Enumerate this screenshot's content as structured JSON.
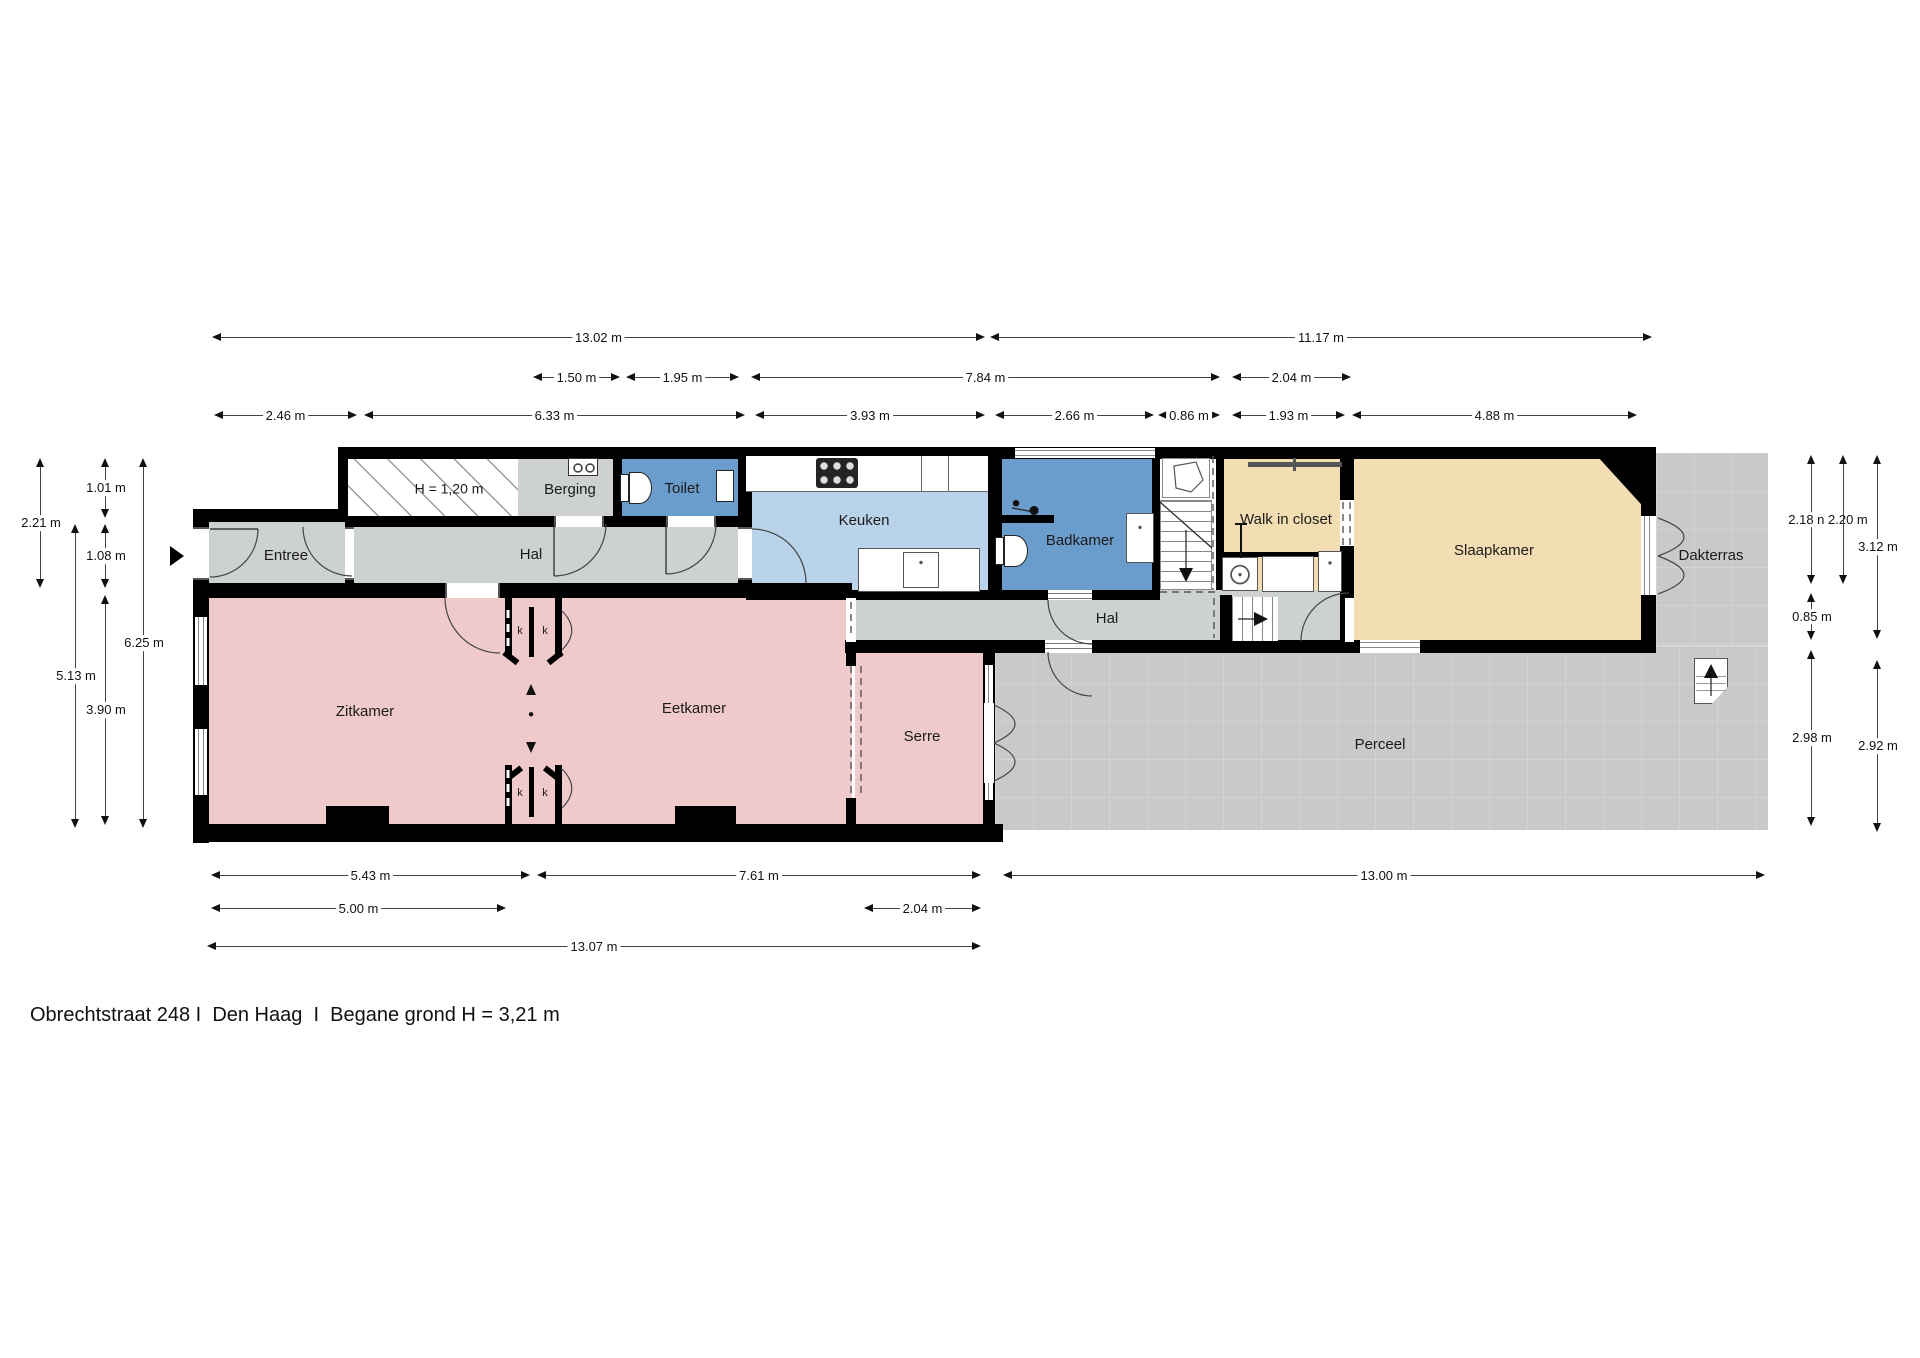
{
  "title": "Obrechtstraat 248 I  Den Haag  I  Begane grond H = 3,21 m",
  "rooms": {
    "entree": "Entree",
    "hal_front": "Hal",
    "berging": "Berging",
    "toilet": "Toilet",
    "low_height": "H = 1,20 m",
    "keuken": "Keuken",
    "badkamer": "Badkamer",
    "hal_back": "Hal",
    "walk_in_closet": "Walk in closet",
    "slaapkamer": "Slaapkamer",
    "dakterras": "Dakterras",
    "zitkamer": "Zitkamer",
    "eetkamer": "Eetkamer",
    "serre": "Serre",
    "perceel": "Perceel",
    "closet_marker": "k"
  },
  "dimensions": {
    "t1": "13.02 m",
    "t2": "11.17 m",
    "t3": "1.50 m",
    "t4": "1.95 m",
    "t5": "7.84 m",
    "t6": "2.04 m",
    "t7": "2.46 m",
    "t8": "6.33 m",
    "t9": "3.93 m",
    "t10": "2.66 m",
    "t11": "0.86 m",
    "t12": "1.93 m",
    "t13": "4.88 m",
    "b1": "5.43 m",
    "b2": "7.61 m",
    "b3": "13.00 m",
    "b4": "5.00 m",
    "b5": "2.04 m",
    "b6": "13.07 m",
    "l1": "2.21 m",
    "l2": "1.01 m",
    "l3": "1.08 m",
    "l4": "6.25 m",
    "l5": "5.13 m",
    "l6": "3.90 m",
    "r1": "2.18 n 2.20 m",
    "r2": "3.12 m",
    "r3": "0.85 m",
    "r4": "2.98 m",
    "r5": "2.92 m"
  },
  "colors": {
    "wall": "#000000",
    "hall_gray": "#cdd1d1",
    "wet_room_blue": "#6b9dcc",
    "kitchen_blue": "#b9d4ea",
    "living_pink": "#f0caca",
    "sleeping_beige": "#f3ddb2",
    "outdoor_gray": "#c9c9c9"
  }
}
